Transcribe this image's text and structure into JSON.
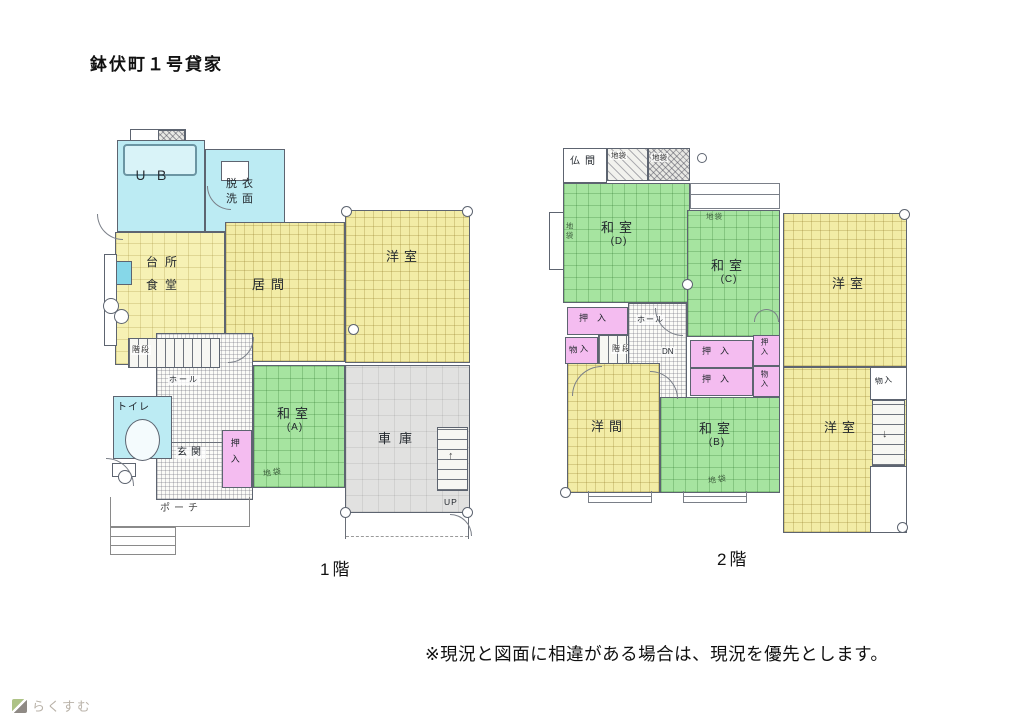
{
  "title": "鉢伏町１号貸家",
  "note": "※現況と図面に相違がある場合は、現況を優先とします。",
  "watermark": "らくすむ",
  "icons": {
    "up_arrow": "↑",
    "down_arrow": "↓"
  },
  "colors": {
    "tatami_yellow": "#f6f1b4",
    "room_green": "#a6e4a0",
    "closet_pink": "#f4bcf0",
    "bath_cyan": "#bcebf3",
    "garage_gray": "#e1e1e0"
  },
  "floor1": {
    "caption": "1階",
    "rooms": {
      "ub": "ＵＢ",
      "datsui1": "脱衣",
      "datsui2": "洗面",
      "kitchen1": "台所",
      "kitchen2": "食堂",
      "living": "居間",
      "western": "洋室",
      "washitsu_a1": "和室",
      "washitsu_a2": "(A)",
      "jibukuro": "地袋",
      "garage": "車庫",
      "toilet": "トイレ",
      "oshiire": "押入",
      "hall": "ホール",
      "genkan": "玄関",
      "porch": "ポーチ",
      "stairs": "階段",
      "up": "UP"
    }
  },
  "floor2": {
    "caption": "2階",
    "rooms": {
      "butsuma": "仏間",
      "jibukuro_t1": "地袋",
      "jibukuro_t2": "地袋",
      "washitsu_d1": "和室",
      "washitsu_d2": "(D)",
      "jibukuro_d": "地袋",
      "washitsu_c1": "和室",
      "washitsu_c2": "(C)",
      "jibukuro_c": "地袋",
      "western_ne": "洋室",
      "oshiire_w": "押入",
      "monoire_w": "物入",
      "stairs": "階段",
      "hall": "ホール",
      "dn": "DN",
      "oshiire_c1": "押入",
      "oshiire_c2": "押入",
      "oshiire_e": "押入",
      "monoire_e": "物入",
      "yoma": "洋間",
      "washitsu_b1": "和室",
      "washitsu_b2": "(B)",
      "jibukuro_b": "地袋",
      "western_se": "洋室",
      "monoire_ne": "物入"
    }
  }
}
